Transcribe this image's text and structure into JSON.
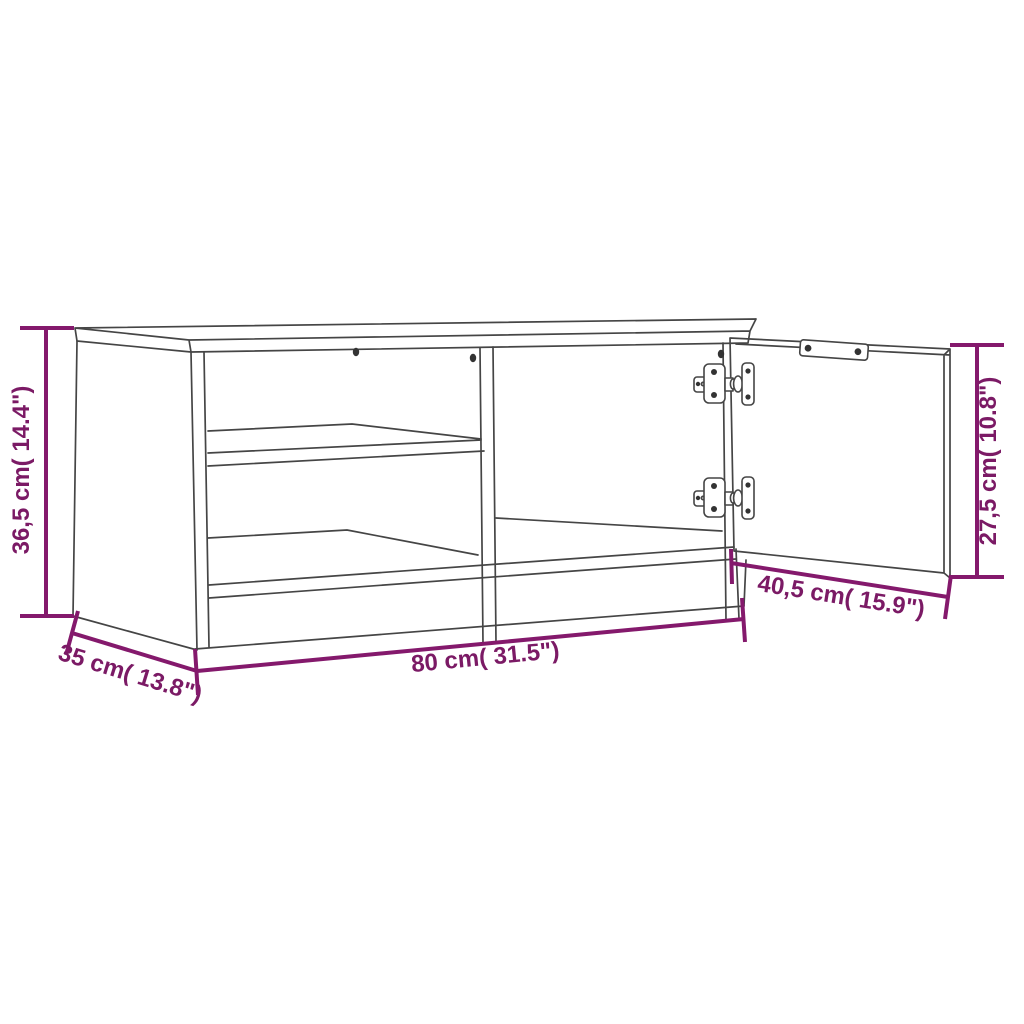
{
  "title": "TV cabinet dimension diagram",
  "product": {
    "type": "TV cabinet line drawing with open left compartment, middle shelf and one door shown open on concealed hinges"
  },
  "colors": {
    "dimension_accent": "#84196c",
    "label_text": "#7b1a65",
    "line_art": "#454545",
    "background": "#ffffff"
  },
  "dimensions": {
    "height": {
      "label": "36,5 cm( 14.4\")",
      "cm": "36,5",
      "inch": "14.4"
    },
    "depth": {
      "label": "35 cm( 13.8\")",
      "cm": "35",
      "inch": "13.8"
    },
    "width": {
      "label": "80 cm( 31.5\")",
      "cm": "80",
      "inch": "31.5"
    },
    "door_width": {
      "label": "40,5 cm( 15.9\")",
      "cm": "40,5",
      "inch": "15.9"
    },
    "door_height": {
      "label": "27,5 cm( 10.8\")",
      "cm": "27,5",
      "inch": "10.8"
    }
  }
}
